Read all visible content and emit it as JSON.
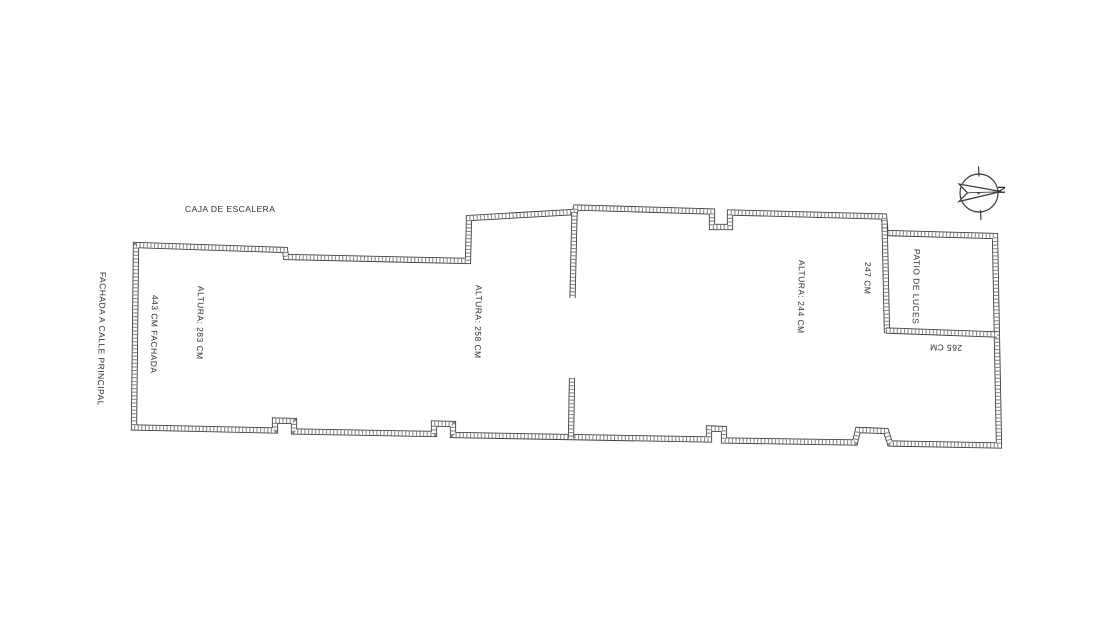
{
  "document": {
    "type": "scanned floor plan",
    "background": "#ffffff",
    "ink": "#3f3f3f",
    "text_color": "#2e2e2e"
  },
  "plan": {
    "stairwell_label": "CAJA DE ESCALERA",
    "street_facade_label": "FACHADA A CALLE PRINCIPAL",
    "facade_dimension_label": "443 CM FACHADA",
    "rooms": [
      {
        "height_label": "ALTURA: 283 CM"
      },
      {
        "height_label": "ALTURA: 258 CM"
      },
      {
        "height_label": "ALTURA: 244 CM"
      }
    ],
    "patio": {
      "name_label": "PATIO DE LUCES",
      "width_label": "247 CM",
      "depth_label": "265 CM"
    },
    "compass": {
      "north_label": "N"
    }
  }
}
